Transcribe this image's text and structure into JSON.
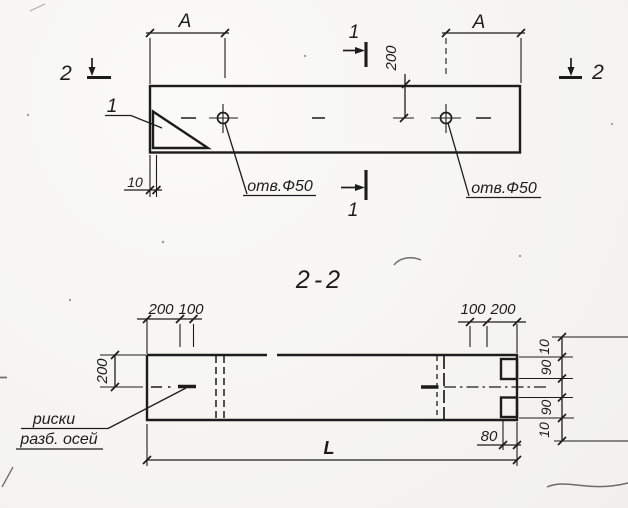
{
  "colors": {
    "ink": "#1c1c1c",
    "paper": "#f6f5f1"
  },
  "plan_view": {
    "dim_a_left": "A",
    "dim_a_right": "A",
    "dim_200": "200",
    "dim_10": "10",
    "hole_label_left": "отв.Ф50",
    "hole_label_right": "отв.Ф50",
    "detail_ref": "1",
    "section_1_top": "1",
    "section_1_bottom": "1",
    "section_2_left": "2",
    "section_2_right": "2"
  },
  "section_view": {
    "title": "2-2",
    "dim_top_left_200": "200",
    "dim_top_left_100": "100",
    "dim_top_right_100": "100",
    "dim_top_right_200": "200",
    "dim_left_200": "200",
    "dim_right_10_top": "10",
    "dim_right_90_top": "90",
    "dim_right_90_bottom": "90",
    "dim_right_10_bottom": "10",
    "dim_80": "80",
    "dim_length": "L",
    "note_line1": "риски",
    "note_line2": "разб. осей"
  }
}
